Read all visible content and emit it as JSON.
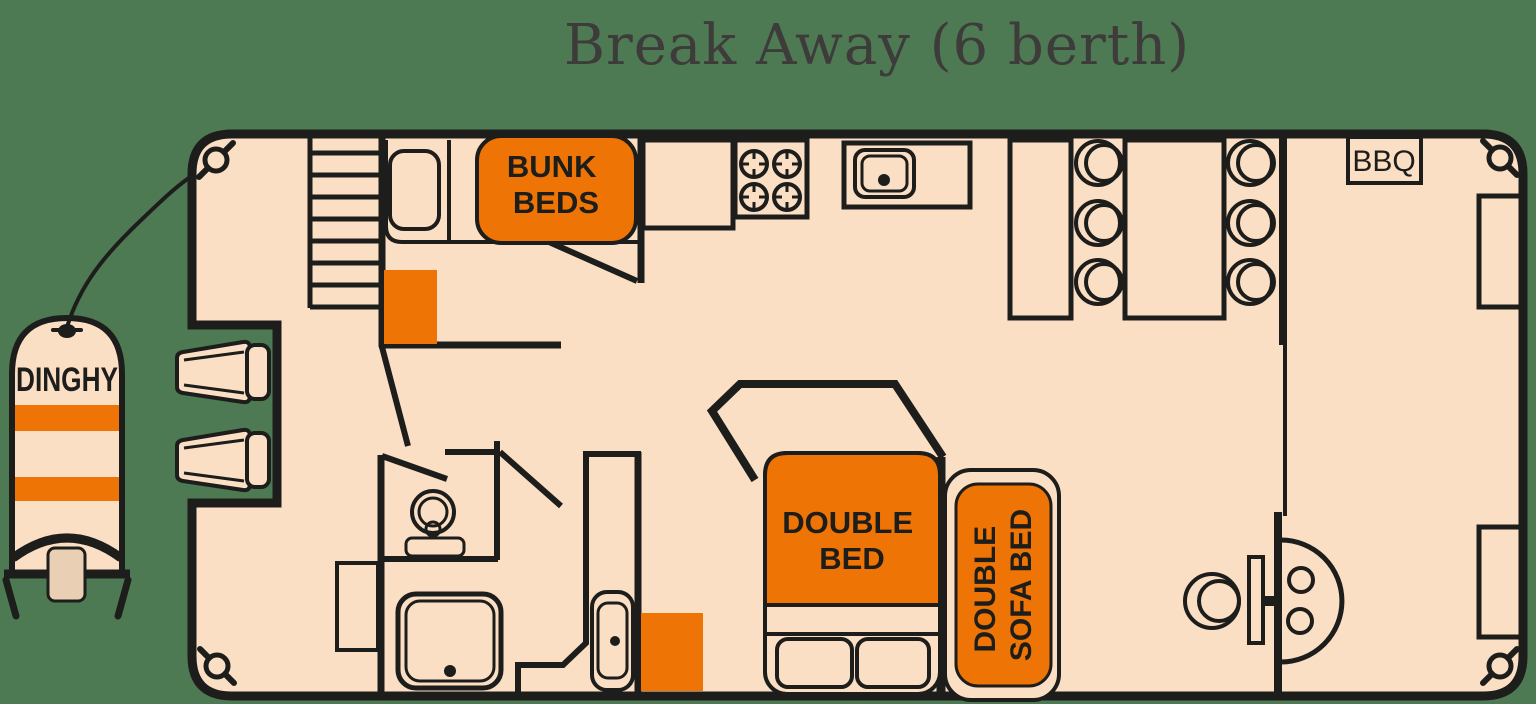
{
  "title": "Break Away (6 berth)",
  "colors": {
    "bg": "#4d7a53",
    "peach": "#fbdfc5",
    "orange": "#ee7405",
    "ink": "#1d1d1b",
    "titleInk": "#3d3c3b",
    "motorTan": "#e9d0b4"
  },
  "labels": {
    "dinghy": "DINGHY",
    "bunk_line1": "BUNK",
    "bunk_line2": "BEDS",
    "double_bed_line1": "DOUBLE",
    "double_bed_line2": "BED",
    "sofa_line1": "DOUBLE",
    "sofa_line2": "SOFA BED",
    "bbq": "BBQ"
  }
}
